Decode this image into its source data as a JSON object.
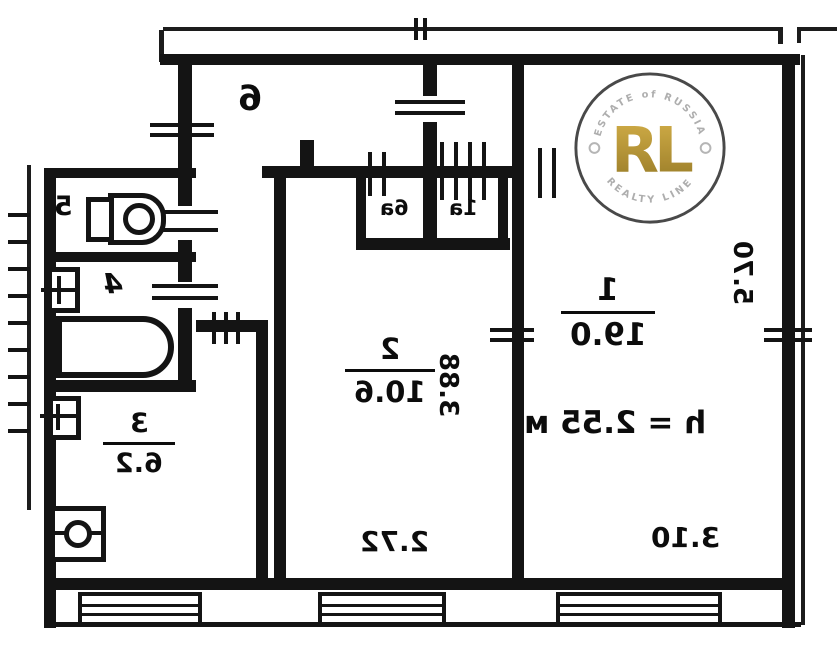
{
  "meta": {
    "kind": "apartment floor plan (mirrored scan)",
    "colors": {
      "wall": "#141414",
      "background": "#ffffff",
      "gold": "#b8912f",
      "arc_text": "#a8a8a8"
    }
  },
  "rooms": {
    "room1": {
      "number": "1",
      "area": "19.0",
      "height_note": "h = 2.55 м"
    },
    "room2": {
      "number": "2",
      "area": "10.6"
    },
    "kitchen": {
      "number": "3",
      "area": "6.2"
    },
    "bathroom": {
      "number": "4"
    },
    "wc": {
      "number": "5"
    },
    "hall": {
      "number": "6"
    },
    "closet_left": {
      "number": "6a"
    },
    "closet_right": {
      "number": "1a"
    }
  },
  "dimensions": {
    "room1_depth": "5.70",
    "room1_width": "3.10",
    "room2_depth": "3.88",
    "room2_width": "2.72"
  },
  "watermark": {
    "monogram": "RL",
    "arc_top": "ESTATE of RUSSIA",
    "arc_bottom": "REALTY LINE"
  }
}
